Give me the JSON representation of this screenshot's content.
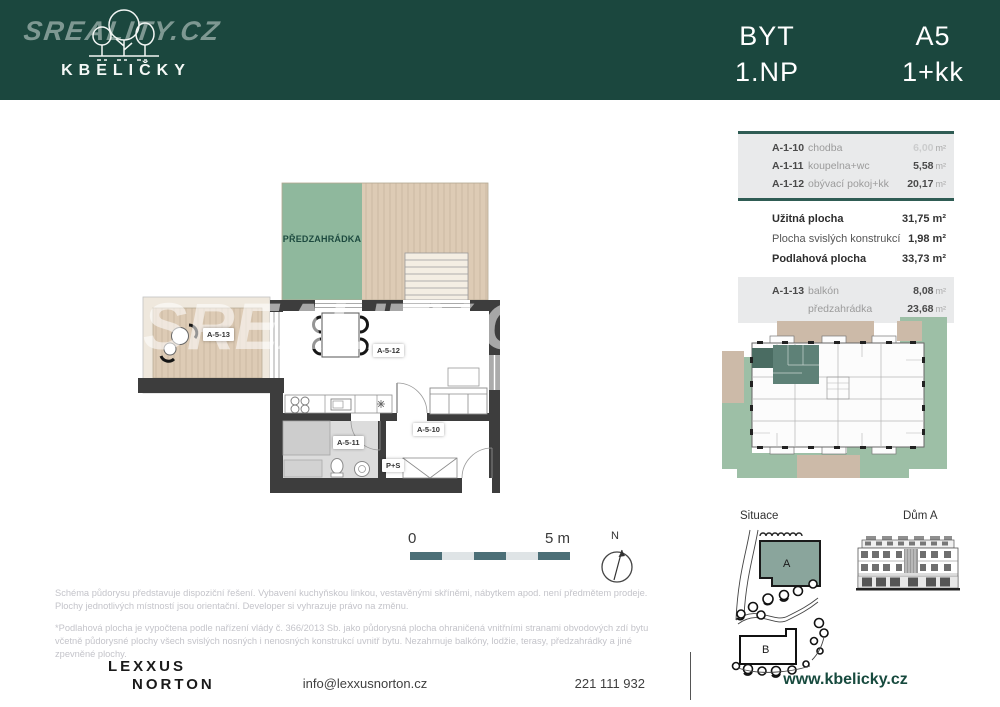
{
  "header": {
    "brand_watermark": "SREALITY.CZ",
    "brand_name": "KBELIČKY",
    "unit_type_label": "BYT",
    "floor_label": "1.NP",
    "unit_code": "A5",
    "layout_code": "1+kk"
  },
  "floor_plan": {
    "garden_label": "PŘEDZAHRÁDKA",
    "watermark": "SREALITY.CZ",
    "room_labels": {
      "balcony": "A-5-13",
      "living": "A-5-12",
      "bathroom": "A-5-11",
      "hall": "A-5-10",
      "closet": "P+S"
    }
  },
  "scale_bar": {
    "start": "0",
    "end": "5 m"
  },
  "compass": {
    "label": "N"
  },
  "area_table": {
    "rooms": [
      {
        "code": "A-1-10",
        "name": "chodba",
        "area": "6,00",
        "unit": "m²"
      },
      {
        "code": "A-1-11",
        "name": "koupelna+wc",
        "area": "5,58",
        "unit": "m²"
      },
      {
        "code": "A-1-12",
        "name": "obývací pokoj+kk",
        "area": "20,17",
        "unit": "m²"
      }
    ],
    "summary": [
      {
        "label": "Užitná plocha",
        "value": "31,75 m²"
      },
      {
        "label": "Plocha svislých konstrukcí",
        "value": "1,98 m²"
      },
      {
        "label": "Podlahová plocha",
        "value": "33,73 m²"
      }
    ],
    "exterior": [
      {
        "code": "A-1-13",
        "name": "balkón",
        "area": "8,08",
        "unit": "m²"
      },
      {
        "code": "",
        "name": "předzahrádka",
        "area": "23,68",
        "unit": "m²"
      }
    ]
  },
  "site": {
    "situace_label": "Situace",
    "dum_label": "Dům A",
    "building_a": "A",
    "building_b": "B"
  },
  "disclaimer": {
    "p1": "Schéma půdorysu představuje dispoziční řešení. Vybavení kuchyňskou linkou, vestavěnými skříněmi, nábytkem apod. není předmětem prodeje. Plochy jednotlivých místností jsou orientační. Developer si vyhrazuje právo na změnu.",
    "p2": "*Podlahová plocha je vypočtena podle nařízení vlády č. 366/2013 Sb. jako půdorysná plocha ohraničená vnitřními stranami obvodových zdí bytu včetně půdorysné plochy všech svislých nosných i nenosných konstrukcí uvnitř bytu. Nezahrnuje balkóny, lodžie, terasy, předzahrádky a jiné zpevněné plochy."
  },
  "footer": {
    "agency_line1": "LEXXUS",
    "agency_line2": "NORTON",
    "email": "info@lexxusnorton.cz",
    "phone": "221 111 932",
    "website": "www.kbelicky.cz"
  },
  "colors": {
    "header_green": "#1b473e",
    "garden_green": "#8fb89d",
    "wood": "#ddcbb5",
    "wall_dark": "#3d3d3d",
    "table_accent_teal": "#2f5c54",
    "scalebar_teal": "#4c6f77",
    "unit_highlight_teal": "#5e8177",
    "link_green": "#174a3e"
  }
}
